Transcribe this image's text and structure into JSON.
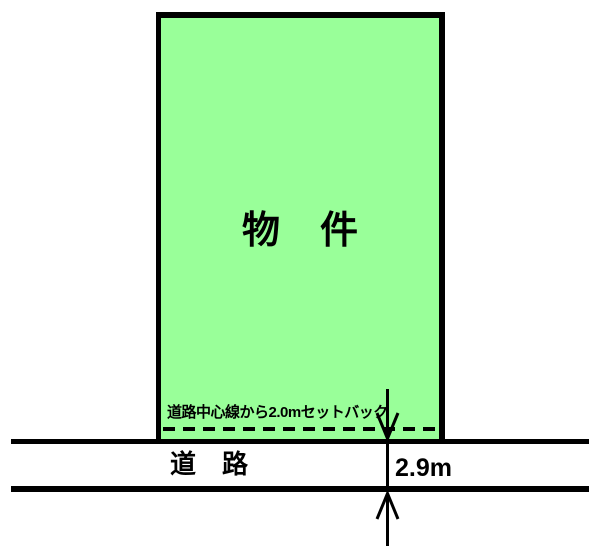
{
  "diagram": {
    "property_label": "物　件",
    "setback_note": "道路中心線から2.0mセットバック",
    "road_label": "道　路",
    "road_width_label": "2.9m",
    "colors": {
      "property_fill": "#99FF99",
      "line_color": "#000000",
      "background": "#FFFFFF"
    }
  }
}
